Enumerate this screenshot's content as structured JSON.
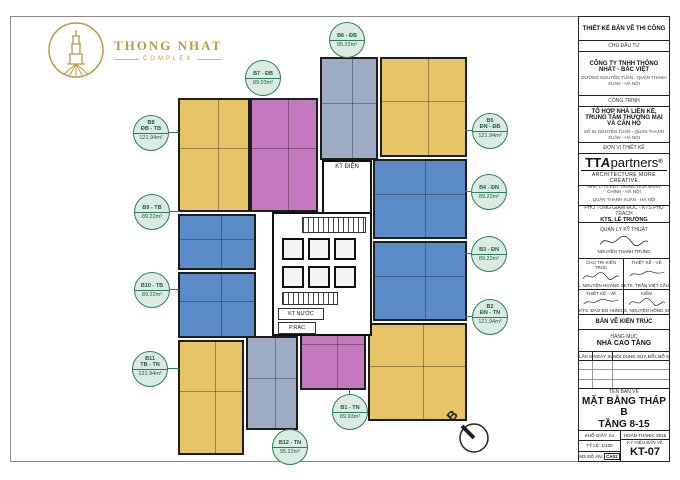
{
  "palette": {
    "yellow": "#E7C466",
    "pink": "#C478BE",
    "blue": "#5B8CC8",
    "bluegray": "#9DACC2",
    "label_green": "#2F7D54",
    "label_fill": "#D9EBE2",
    "wall": "#1D1D1D",
    "gold": "#B99A45"
  },
  "logo": {
    "name": "THONG NHAT",
    "subtitle": "COMPLEX"
  },
  "plan": {
    "labels": [
      {
        "line1": "B8",
        "line2": "ĐB - TB",
        "area": "121.94m²",
        "color": "yellow"
      },
      {
        "line1": "B7 - ĐB",
        "line2": "",
        "area": "89.93m²",
        "color": "pink"
      },
      {
        "line1": "B6 - ĐB",
        "line2": "",
        "area": "95.22m²",
        "color": "bluegray"
      },
      {
        "line1": "B5",
        "line2": "ĐN - ĐB",
        "area": "121.94m²",
        "color": "yellow"
      },
      {
        "line1": "B4 - ĐN",
        "line2": "",
        "area": "89.22m²",
        "color": "blue"
      },
      {
        "line1": "B3 - ĐN",
        "line2": "",
        "area": "89.22m²",
        "color": "blue"
      },
      {
        "line1": "B2",
        "line2": "ĐN - TN",
        "area": "121.94m²",
        "color": "yellow"
      },
      {
        "line1": "B1 - TN",
        "line2": "",
        "area": "89.93m²",
        "color": "pink"
      },
      {
        "line1": "B12 - TN",
        "line2": "",
        "area": "95.22m²",
        "color": "bluegray"
      },
      {
        "line1": "B11",
        "line2": "TB - TN",
        "area": "121.94m²",
        "color": "yellow"
      },
      {
        "line1": "B10 - TB",
        "line2": "",
        "area": "89.22m²",
        "color": "blue"
      },
      {
        "line1": "B9 - TB",
        "line2": "",
        "area": "89.22m²",
        "color": "blue"
      }
    ],
    "core": {
      "kt_dien": "KT ĐIỆN",
      "kt_nuoc": "KT NƯỚC",
      "p_rac": "P.RÁC"
    },
    "north_label": "B"
  },
  "title_block": {
    "stage": "THIẾT KẾ BẢN VẼ THI CÔNG",
    "client_label": "CHỦ ĐẦU TƯ",
    "client_name": "CÔNG TY TNHH THỐNG NHẤT - BẮC VIỆT",
    "client_address": "ĐƯỜNG NGUYỄN TUÂN - QUẬN THANH XUÂN - HÀ NỘI",
    "project_label": "CÔNG TRÌNH",
    "project_name_1": "TỔ HỢP NHÀ LIỀN KỀ,",
    "project_name_2": "TRUNG TÂM THƯƠNG MẠI VÀ CĂN HỘ",
    "project_address": "SỐ 82 NGUYỄN TUÂN - QUẬN THANH XUÂN - HÀ NỘI",
    "designer_label": "ĐƠN VỊ THIẾT KẾ",
    "designer_logo_tt": "TT",
    "designer_logo_a": "A",
    "designer_logo_rest": "partners",
    "designer_logo_reg": "®",
    "designer_tagline": "ARCHITECTURE MORE CREATIVE",
    "designer_address_1": "NHÀ 17T5 KĐT TRUNG HÒA NHÂN CHÍNH - HÀ NỘI",
    "designer_address_2": "QUẬN THANH XUÂN - HÀ NỘI",
    "designer_address_3": "TEL: 84 4 35565456 - FAX: 84 4 35565457",
    "director_label": "PHÓ TỔNG GIÁM ĐỐC - KTS PHỤ TRÁCH",
    "director_name": "KTS. LÊ TRƯỜNG",
    "tech_manager_label": "QUẢN LÝ KỸ THUẬT",
    "tech_manager_name": "NGUYỄN THANH TRUNG",
    "sig_1_label": "CHỦ TRÌ KIẾN TRÚC",
    "sig_1_name": "KTS. NGUYỄN HOÀNG SƠN",
    "sig_2_label": "THIẾT KẾ - VẼ",
    "sig_2_name": "KTS. TRẦN VIỆT CẦU",
    "sig_3_label": "THIẾT KẾ - VẼ",
    "sig_3_name": "KTS. ĐÀO ĐỖ HÙNG",
    "sig_4_label": "KIỂM",
    "sig_4_name": "KTS. NGUYỄN HỒNG SƠN",
    "discipline": "BẢN VẼ KIẾN TRÚC",
    "category_label": "HẠNG MỤC",
    "category_value": "NHÀ CAO TẦNG",
    "rev_col_1": "LẦN SỐ",
    "rev_col_2": "NGÀY SỬA",
    "rev_col_3": "NỘI DUNG SỬA ĐỔI, BỔ SUNG",
    "drawing_name_label": "TÊN BẢN VẼ",
    "drawing_name_1": "MẶT BẰNG THÁP B",
    "drawing_name_2": "TẦNG 8-15",
    "paper_label": "KHỔ GIẤY: A4",
    "date_label": "HOÀN THÀNH: 2016",
    "scale_label": "TỶ LỆ: 1/100",
    "project_code_label": "MS ĐỒ ÁN:",
    "project_code": "CA02",
    "drawing_no_label": "KÝ HIỆU BẢN VẼ",
    "drawing_no": "KT-07"
  }
}
